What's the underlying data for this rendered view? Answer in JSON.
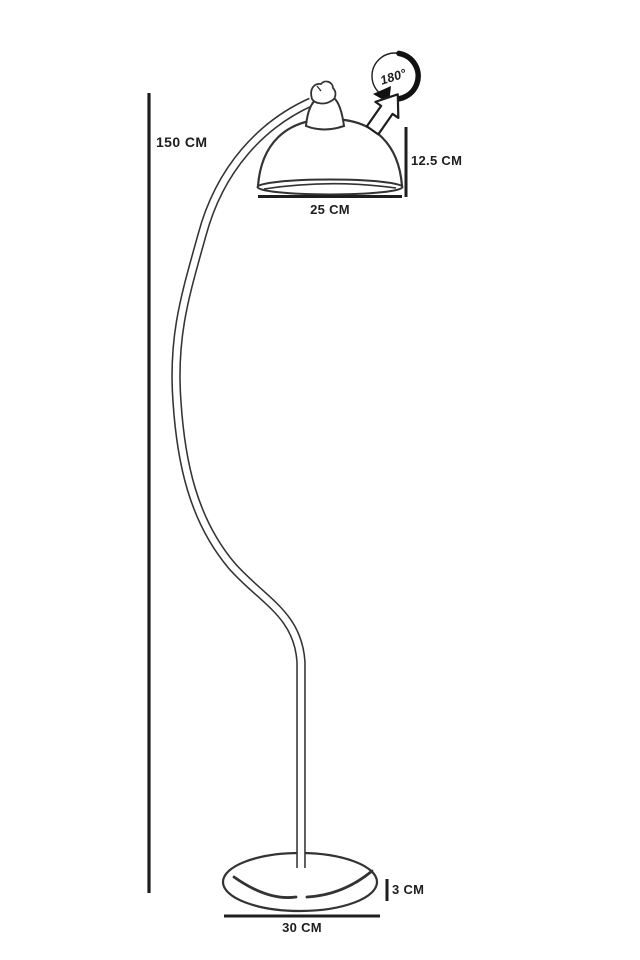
{
  "figure": {
    "type": "product-dimension-line-drawing",
    "subject": "arc floor lamp"
  },
  "colors": {
    "background": "#ffffff",
    "dimension_ink": "#1e1e1e",
    "drawing_ink": "#333333"
  },
  "dimensions": {
    "lamp_height": "150 CM",
    "shade_height": "12.5 CM",
    "shade_diameter": "25 CM",
    "base_height": "3 CM",
    "base_diameter": "30 CM"
  },
  "rotation_badge": {
    "label": "180°",
    "icon": "circular-rotation-arrow-icon"
  },
  "swivel_arrow": {
    "icon": "outline-arrow-up-right-icon"
  }
}
